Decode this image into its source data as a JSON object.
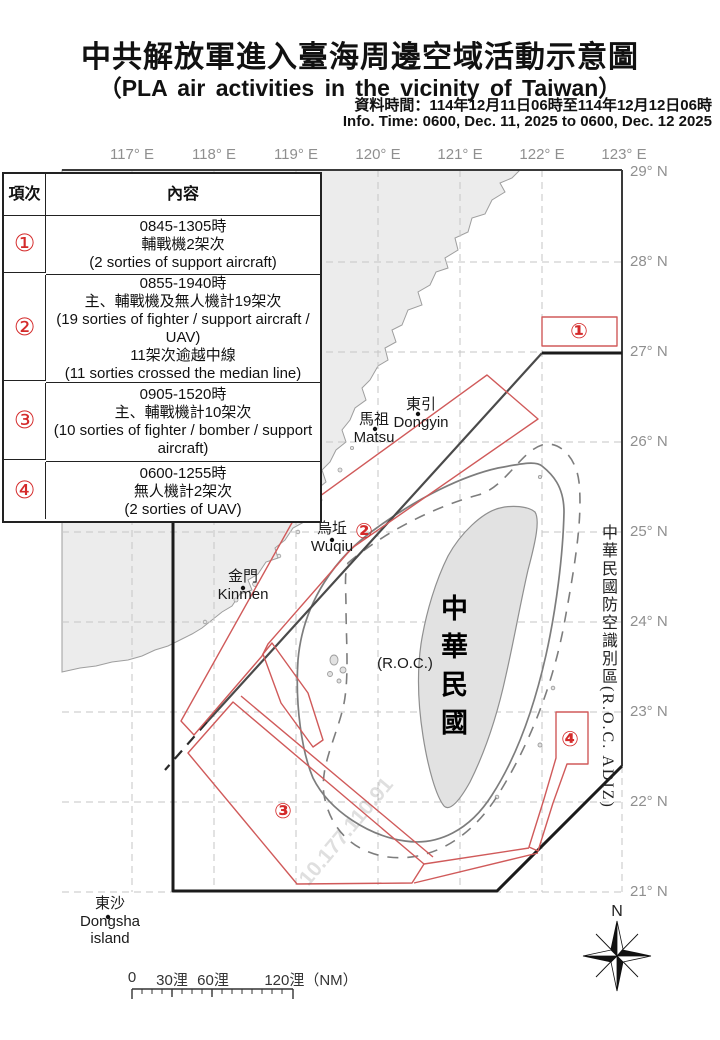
{
  "title": {
    "zh": "中共解放軍進入臺海周邊空域活動示意圖",
    "en": "（PLA air activities in the vicinity of Taiwan）",
    "data_time_zh": "資料時間：114年12月11日06時至114年12月12日06時",
    "data_time_en": "Info. Time: 0600, Dec. 11, 2025 to 0600, Dec. 12 2025"
  },
  "table": {
    "col_item": "項次",
    "col_content": "內容",
    "rows": [
      {
        "no": "①",
        "lines": [
          "0845-1305時",
          "輔戰機2架次",
          "(2 sorties of support aircraft)"
        ]
      },
      {
        "no": "②",
        "lines": [
          "0855-1940時",
          "主、輔戰機及無人機計19架次",
          "(19 sorties of fighter / support aircraft / UAV)",
          "11架次逾越中線",
          "(11 sorties crossed the median line)"
        ]
      },
      {
        "no": "③",
        "lines": [
          "0905-1520時",
          "主、輔戰機計10架次",
          "(10 sorties of fighter / bomber / support aircraft)"
        ]
      },
      {
        "no": "④",
        "lines": [
          "0600-1255時",
          "無人機計2架次",
          "(2 sorties of UAV)"
        ]
      }
    ]
  },
  "map": {
    "lon_labels": [
      "117° E",
      "118° E",
      "119° E",
      "120° E",
      "121° E",
      "122° E",
      "123° E"
    ],
    "lat_labels": [
      "29° N",
      "28° N",
      "27° N",
      "26° N",
      "25° N",
      "24° N",
      "23° N",
      "22° N",
      "21° N"
    ],
    "places": {
      "dongyin": [
        "東引",
        "Dongyin"
      ],
      "matsu": [
        "馬祖",
        "Matsu"
      ],
      "wuqiu": [
        "烏坵",
        "Wuqiu"
      ],
      "kinmen": [
        "金門",
        "Kinmen"
      ],
      "dongsha": [
        "東沙",
        "Dongsha",
        "island"
      ],
      "roc_paren": "(R.O.C.)",
      "taiwan_vertical": "中華民國"
    },
    "adiz_label": "中華民國防空識別區(R.O.C. ADIZ)",
    "region_markers": [
      "①",
      "②",
      "③",
      "④"
    ],
    "compass_n": "N",
    "scale": {
      "t0": "0",
      "t30": "30浬",
      "t60": "60浬",
      "t120": "120浬（NM）"
    },
    "watermark": "10.177.110.91"
  },
  "colors": {
    "region_red": "#d05a5a",
    "marker_red": "#d42a2a",
    "adiz_black": "#1b1b1b",
    "median_gray": "#4a4a4a",
    "contour_gray": "#7d7d7d",
    "grid_gray": "#c6c6c6",
    "land_gray": "#ececec",
    "taiwan_gray": "#e2e2e2"
  }
}
